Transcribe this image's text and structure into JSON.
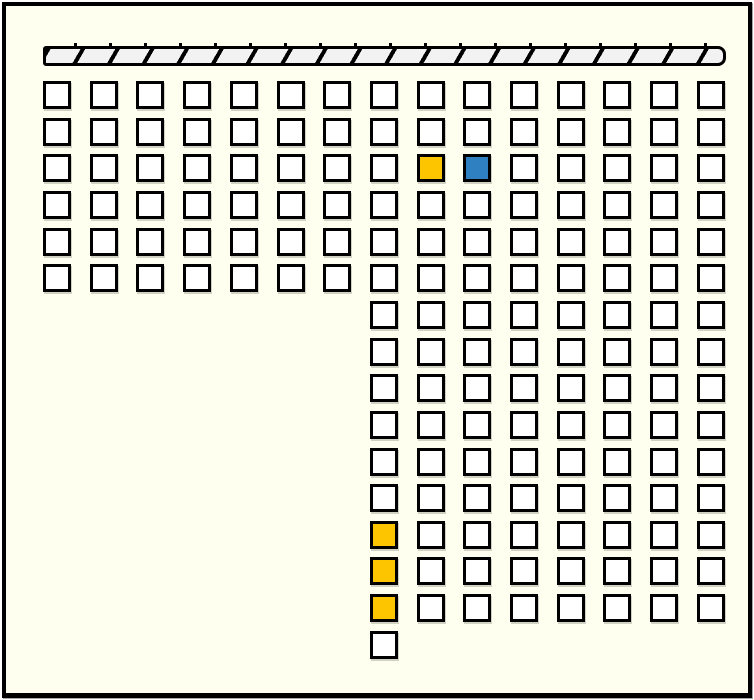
{
  "window": {
    "background": "#FFFFF0",
    "frame_color": "#000000"
  },
  "stage_bar": {
    "x": 37,
    "y": 40,
    "width": 683,
    "height": 20,
    "fill": "#F2F2F2",
    "stripe_color": "#000000"
  },
  "seat_map": {
    "origin_x": 37,
    "origin_y": 75,
    "col_pitch": 46.7,
    "row_pitch": 36.65,
    "seat_size": 28,
    "colors": {
      "available": "#FFFFFF",
      "selected": "#FDC500",
      "occupied": "#2E80C0",
      "border": "#000000"
    },
    "legend": {
      "W": "available",
      "Y": "selected",
      "B": "occupied"
    },
    "rows": [
      "WWWWWWWWWWWWWWW",
      "WWWWWWWWWWWWWWW",
      "WWWWWWWWYBWWWWW",
      "WWWWWWWWWWWWWWW",
      "WWWWWWWWWWWWWWW",
      "WWWWWWWWWWWWWWW",
      ".......WWWWWWWW",
      ".......WWWWWWWW",
      ".......WWWWWWWW",
      ".......WWWWWWWW",
      ".......WWWWWWWW",
      ".......WWWWWWWW",
      ".......YWWWWWWW",
      ".......YWWWWWWW",
      ".......YWWWWWWW",
      ".......W......."
    ]
  }
}
